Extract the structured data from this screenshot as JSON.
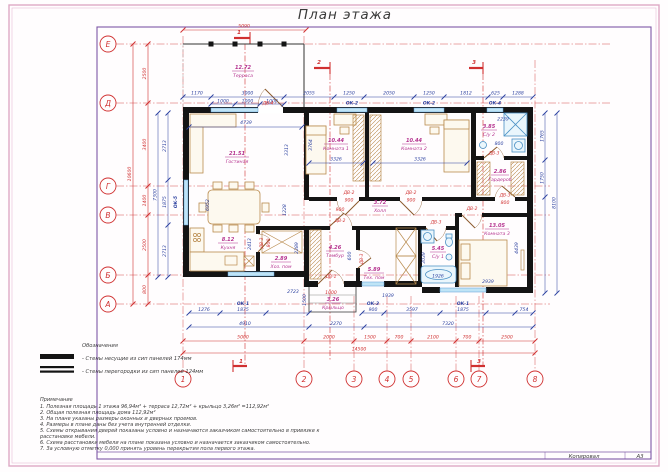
{
  "title": "План этажа",
  "footer": {
    "kopiroval": "Копировал",
    "format": "А3"
  },
  "axes": {
    "letters": [
      "Е",
      "Д",
      "Г",
      "В",
      "Б",
      "А"
    ],
    "numbers": [
      "1",
      "2",
      "3",
      "4",
      "5",
      "6",
      "7",
      "8"
    ]
  },
  "sections": {
    "s1": "1",
    "s2": "2",
    "s3": "3"
  },
  "rooms": {
    "terrace": {
      "area": "12.72",
      "name": "Терраса"
    },
    "living": {
      "area": "21.51",
      "name": "Гостиная"
    },
    "kitchen": {
      "area": "8.12",
      "name": "Кухня"
    },
    "room1": {
      "area": "10.44",
      "name": "Комната 1"
    },
    "room2": {
      "area": "10.44",
      "name": "Комната 2"
    },
    "su2": {
      "area": "3.85",
      "name": "С/у 2"
    },
    "wardrobe": {
      "area": "2.86",
      "name": "Гардероб"
    },
    "hall": {
      "area": "3.72",
      "name": "Холл"
    },
    "utility": {
      "area": "2.89",
      "name": "Хоз. пом"
    },
    "tambur": {
      "area": "4.26",
      "name": "Тамбур"
    },
    "tech": {
      "area": "5.89",
      "name": "Тех. пом"
    },
    "su1": {
      "area": "5.45",
      "name": "С/у 1"
    },
    "room3": {
      "area": "13.05",
      "name": "Комната 3"
    },
    "porch": {
      "area": "3.26",
      "name": "Крыльцо"
    }
  },
  "openings": {
    "ok1": "ОК-1",
    "ok2": "ОК-2",
    "ok3": "ОК-3",
    "ok4": "ОК-4",
    "ok5": "ОК-5",
    "dv1": "ДВ-1",
    "dv2": "ДВ-2",
    "dv3": "ДВ-3",
    "dv4": "ДВ-4"
  },
  "dims": {
    "top_total": "5090",
    "top_row": [
      "1170",
      "3000",
      "2055",
      "1250",
      "2050",
      "1250",
      "1812",
      "625",
      "1288"
    ],
    "top_sub": [
      "1000",
      "1000",
      "1000"
    ],
    "left_red": [
      "2500",
      "3400",
      "1400",
      "2500",
      "800"
    ],
    "left_red_total": "10600",
    "left_blue": [
      "2713",
      "1875",
      "2713"
    ],
    "left_blue_total": "7300",
    "right_blue": [
      "1765",
      "1750"
    ],
    "right_total": "8100",
    "bottom_row1": [
      "1276",
      "1875",
      "2723",
      "1939",
      "900",
      "3597",
      "1875",
      "754"
    ],
    "bottom_row2": [
      "4910",
      "2270",
      "7320"
    ],
    "bottom_red": [
      "5000",
      "2000",
      "1500",
      "700",
      "2100",
      "700",
      "2500"
    ],
    "bottom_total": "14500",
    "living": [
      "4739",
      "6952",
      "3313",
      "1228"
    ],
    "kitchen_depth": "2413",
    "room1": [
      "3326",
      "3764"
    ],
    "room2": "3326",
    "su2": [
      "2239",
      "800"
    ],
    "wardrobe_door": "800",
    "room1_door": "900",
    "room2_door": "900",
    "tambur_door": "900",
    "tambur_depth": "600",
    "entry_door": "1000",
    "utility_door": "800",
    "utility_depth": "2289",
    "su1": [
      "3039",
      "1926"
    ],
    "room3": [
      "2939",
      "4439"
    ],
    "porch_height": "1500"
  },
  "legend": {
    "heading": "Обозначения",
    "bearing": "- Стены несущие из сип панелей 174мм",
    "partition": "- Стены перегородки из сип панелей 124мм"
  },
  "notes": {
    "heading": "Примечание",
    "lines": [
      "1. Полезная площадь 1 этажа 96,94м² + терраса 12,72м² + крыльцо 3,26м² =112,92м²",
      "2. Общая полезная площадь дома 112,92м²",
      "3. На плане указаны размеры оконных и дверных проемов.",
      "4. Размеры в плане даны без учета внутренней отделки.",
      "5. Схемы открывания дверей показаны условно и назначаются заказчиком самостоятельно в привязке к",
      "расстановке мебели.",
      "6. Схема расстановки мебели на плане показана условно и назначается заказчиком самостоятельно.",
      "7. За условную отметку 0,000 принять уровень перекрытия пола первого этажа."
    ]
  }
}
